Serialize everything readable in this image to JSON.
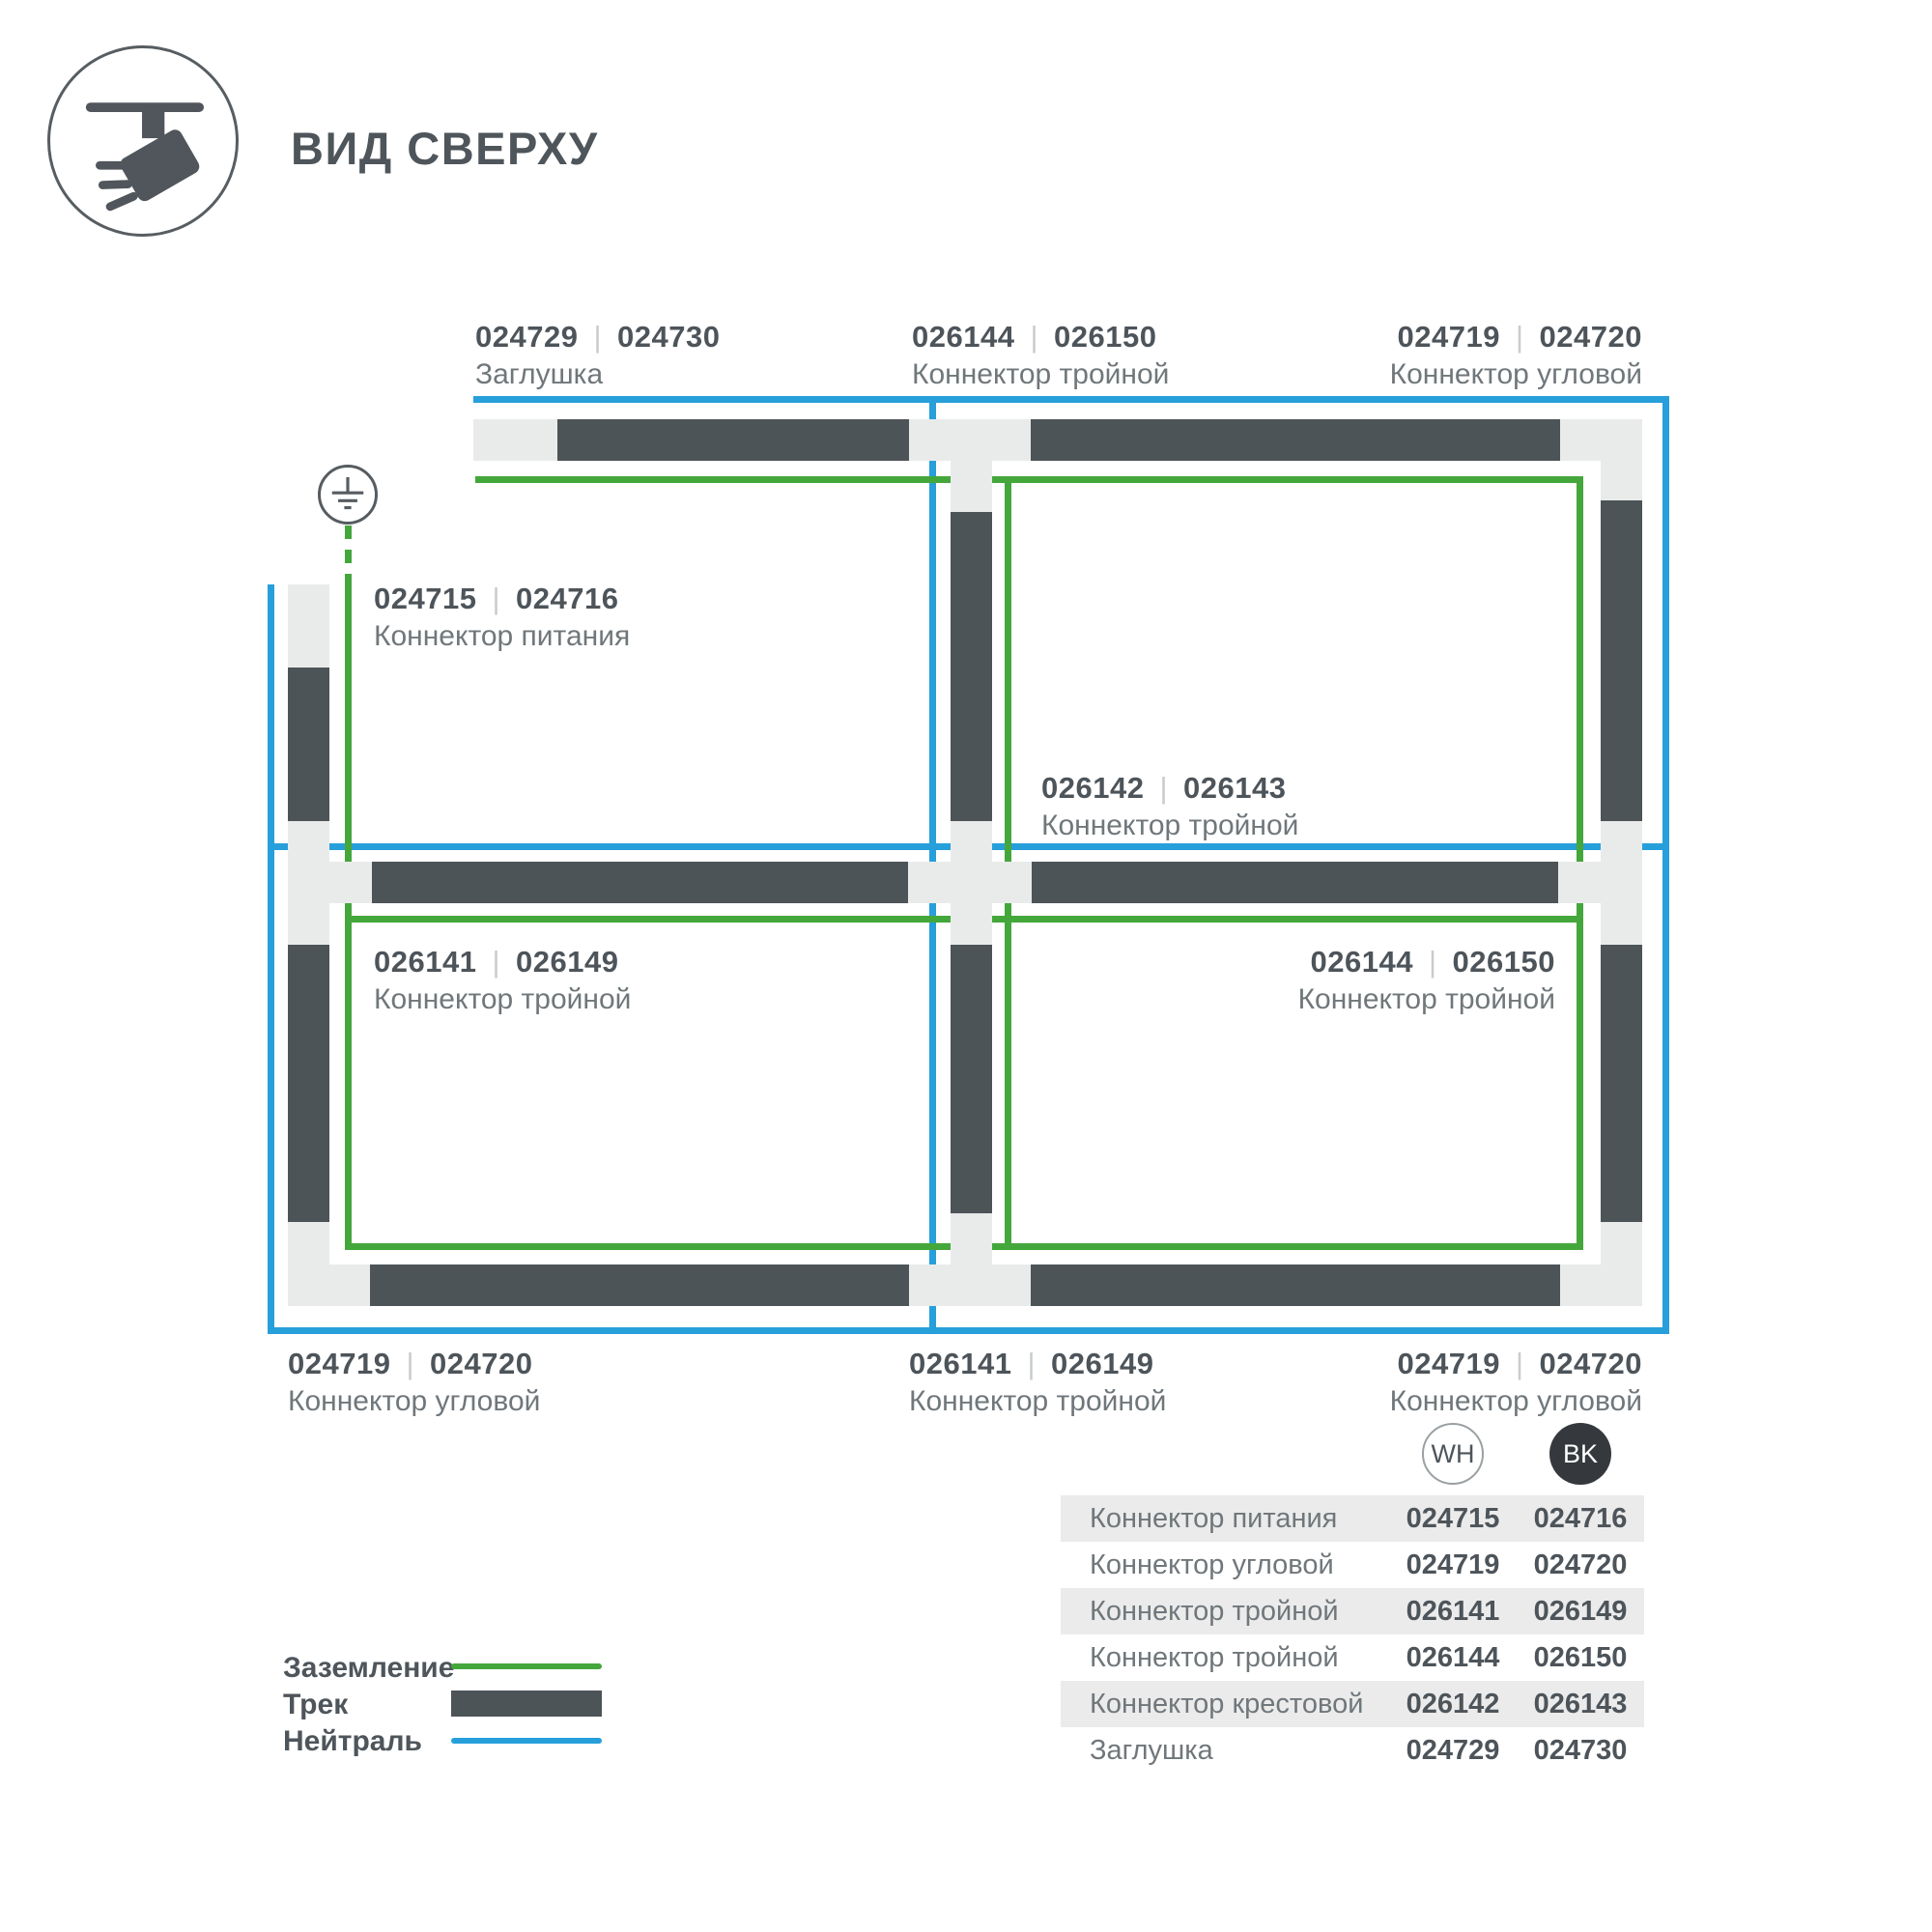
{
  "header": {
    "title": "ВИД СВЕРХУ"
  },
  "ui": {
    "code_separator": "|"
  },
  "colors": {
    "track": "#4d5458",
    "connector": "#e9ebea",
    "neutral_blue": "#279fda",
    "ground_green": "#44a73b",
    "text_dark": "#4d545a",
    "text_gray": "#70777b",
    "table_row_bg": "#ebebeb",
    "bk_badge": "#35393d"
  },
  "variants": {
    "white_label": "WH",
    "black_label": "BK"
  },
  "diagram": {
    "labels": [
      {
        "code_wh": "024729",
        "code_bk": "024730",
        "name": "Заглушка"
      },
      {
        "code_wh": "026144",
        "code_bk": "026150",
        "name": "Коннектор тройной"
      },
      {
        "code_wh": "024719",
        "code_bk": "024720",
        "name": "Коннектор угловой"
      },
      {
        "code_wh": "024715",
        "code_bk": "024716",
        "name": "Коннектор питания"
      },
      {
        "code_wh": "026142",
        "code_bk": "026143",
        "name": "Коннектор тройной"
      },
      {
        "code_wh": "026141",
        "code_bk": "026149",
        "name": "Коннектор тройной"
      },
      {
        "code_wh": "026144",
        "code_bk": "026150",
        "name": "Коннектор тройной"
      },
      {
        "code_wh": "024719",
        "code_bk": "024720",
        "name": "Коннектор угловой"
      },
      {
        "code_wh": "026141",
        "code_bk": "026149",
        "name": "Коннектор тройной"
      },
      {
        "code_wh": "024719",
        "code_bk": "024720",
        "name": "Коннектор угловой"
      }
    ]
  },
  "table": {
    "columns": [
      "WH",
      "BK"
    ],
    "rows": [
      {
        "name": "Коннектор питания",
        "wh": "024715",
        "bk": "024716"
      },
      {
        "name": "Коннектор угловой",
        "wh": "024719",
        "bk": "024720"
      },
      {
        "name": "Коннектор тройной",
        "wh": "026141",
        "bk": "026149"
      },
      {
        "name": "Коннектор тройной",
        "wh": "026144",
        "bk": "026150"
      },
      {
        "name": "Коннектор крестовой",
        "wh": "026142",
        "bk": "026143"
      },
      {
        "name": "Заглушка",
        "wh": "024729",
        "bk": "024730"
      }
    ]
  },
  "legend": {
    "items": [
      {
        "label": "Заземление",
        "swatch": "ground-line"
      },
      {
        "label": "Трек",
        "swatch": "track-bar"
      },
      {
        "label": "Нейтраль",
        "swatch": "neutral-line"
      }
    ]
  }
}
